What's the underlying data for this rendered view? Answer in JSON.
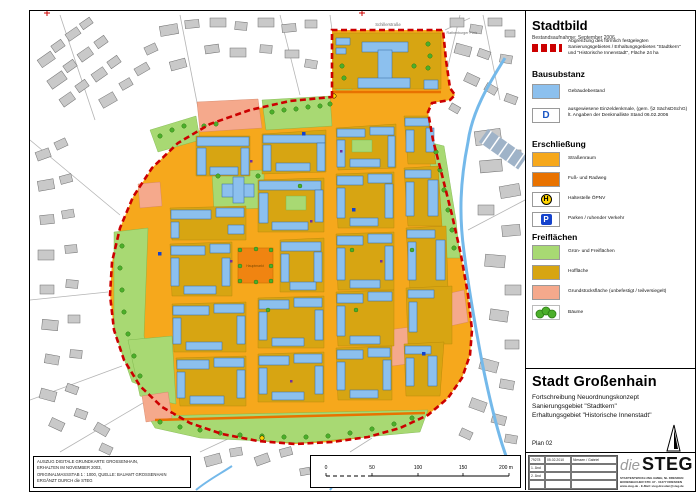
{
  "panel": {
    "title": "Stadtbild",
    "subtitle": "Bestandsaufnahme: September 2006",
    "boundary_label": "Abgrenzung des förmlich festgelegten Sanierungsgebietes / Erhaltungsgebietes \"Stadtkern\" und \"Historische Innenstadt\", Fläche 24 ha",
    "sections": {
      "bausubstanz": "Bausubstanz",
      "erschliessung": "Erschließung",
      "freiflaechen": "Freiflächen"
    },
    "items": {
      "gebaeudebestand": "Gebäudebestand",
      "denkmal_symbol": "D",
      "denkmal": "ausgewiesene Einzeldenkmale, (gem. §2 SächsDSchG) lt. Angaben der Denkmalliste Stand 06.02.2006",
      "strassenraum": "Straßenraum",
      "fuss_radweg": "Fuß- und Radweg",
      "haltestelle_symbol": "H",
      "haltestelle": "Haltestelle ÖPNV",
      "parken_symbol": "P",
      "parken": "Parken / ruhender Verkehr",
      "gruen": "Grün- und Freiflächen",
      "hofflaeche": "Hoffläche",
      "grundstueck": "Grundstücksfläche (unbefestigt / teilversiegelt)",
      "baeume": "Bäume"
    }
  },
  "title_block": {
    "city": "Stadt Großenhain",
    "line1": "Fortschreibung Neuordnungskonzept",
    "line2": "Sanierungsgebiet \"Stadtkern\"",
    "line3": "Erhaltungsgebiet \"Historische Innenstadt\"",
    "plan_no": "Plan 02"
  },
  "revision_table": {
    "ref": "79278",
    "row1_date": "05.02.2010",
    "row1_name": "Niessen / Gabriel",
    "rows": [
      "1. Änd",
      "2. Änd"
    ]
  },
  "logo": {
    "die": "die",
    "steg": "STEG",
    "address1": "STADTENTWICKLUNG GMBH, NL DRESDEN",
    "address2": "BODENBACHER STR. 97 · 01277 DRESDEN",
    "address3": "www.steg.de · E-Mail: steg.dresden@steg.de"
  },
  "source_box": {
    "line1": "AUSZUG DIGITALE GRUNDKARTE GROSSENHAIN,",
    "line2": "ERHALTEN IM NOVEMBER 2003,",
    "line3": "ORIGINALMASSSTAB 1 : 1000, QUELLE: BAUAMT GROSSENHAIN",
    "line4": "ERGÄNZT DURCH die STEG"
  },
  "scale_bar": {
    "ticks": [
      "0",
      "50",
      "100",
      "150",
      "200 m"
    ]
  },
  "map_labels": {
    "schillerstrasse": "Schillerstraße",
    "hauptmarkt": "Hauptmarkt",
    "rathenburger_platz": "Rathenburger Platz"
  },
  "colors": {
    "building": "#8cc0ee",
    "street": "#f6a81c",
    "footpath": "#e87200",
    "green": "#a8d973",
    "courtyard": "#d7a512",
    "plot": "#f5a98c",
    "tree": "#4caf2a",
    "boundary": "#cc0000",
    "water": "#74b9ea",
    "outside_building": "#c9c9c9"
  }
}
